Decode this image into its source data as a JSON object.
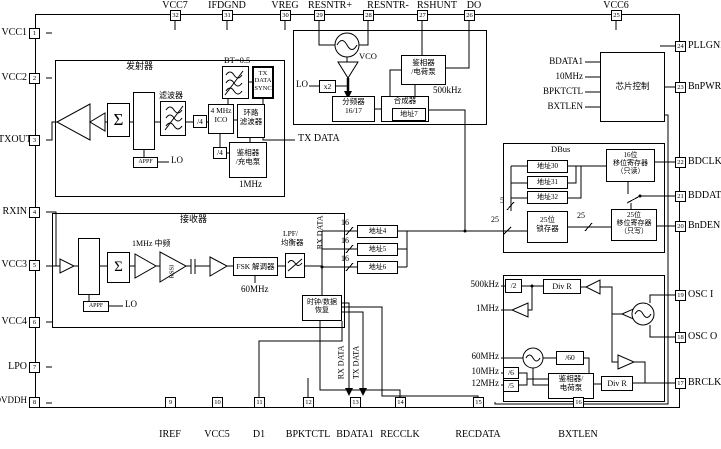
{
  "pins": {
    "top": [
      {
        "n": "32",
        "l": "VCC7"
      },
      {
        "n": "31",
        "l": "IFDGND"
      },
      {
        "n": "30",
        "l": "VREG"
      },
      {
        "n": "29",
        "l": "RESNTR+"
      },
      {
        "n": "28",
        "l": "RESNTR-"
      },
      {
        "n": "27",
        "l": "RSHUNT"
      },
      {
        "n": "26",
        "l": "DO"
      },
      {
        "n": "25",
        "l": "VCC6"
      }
    ],
    "left": [
      {
        "n": "1",
        "l": "VCC1"
      },
      {
        "n": "2",
        "l": "VCC2"
      },
      {
        "n": "3",
        "l": "TXOUT"
      },
      {
        "n": "4",
        "l": "RXIN"
      },
      {
        "n": "5",
        "l": "VCC3"
      },
      {
        "n": "6",
        "l": "VCC4"
      },
      {
        "n": "7",
        "l": "LPO"
      },
      {
        "n": "8",
        "l": "DVDDH"
      }
    ],
    "right": [
      {
        "n": "24",
        "l": "PLLGND"
      },
      {
        "n": "23",
        "l": "BnPWR"
      },
      {
        "n": "22",
        "l": "BDCLK"
      },
      {
        "n": "21",
        "l": "BDDATA"
      },
      {
        "n": "20",
        "l": "BnDEN"
      },
      {
        "n": "19",
        "l": "OSC I"
      },
      {
        "n": "18",
        "l": "OSC O"
      },
      {
        "n": "17",
        "l": "BRCLK"
      }
    ],
    "bottom": [
      {
        "n": "9",
        "l": "IREF"
      },
      {
        "n": "10",
        "l": "VCC5"
      },
      {
        "n": "11",
        "l": "D1"
      },
      {
        "n": "12",
        "l": "BPKTCTL"
      },
      {
        "n": "13",
        "l": "BDATA1"
      },
      {
        "n": "14",
        "l": "RECCLK"
      },
      {
        "n": "15",
        "l": "RECDATA"
      },
      {
        "n": "16",
        "l": "BXTLEN"
      }
    ]
  },
  "tx": {
    "title": "发射器",
    "sigma": "Σ",
    "filter": "滤波器",
    "div4a": "/4",
    "div4b": "/4",
    "ico1": "4 MHz",
    "ico2": "ICO",
    "loop1": "环路",
    "loop2": "滤波器",
    "bt": "BT=0.5",
    "sync1": "TX",
    "sync2": "DATA",
    "sync3": "SYNC",
    "pd1": "鉴相器",
    "pd2": "/充电泵",
    "f1": "1MHz",
    "appf": "APPF",
    "lo": "LO",
    "txdata": "TX DATA"
  },
  "syn": {
    "vco": "VCO",
    "lo": "LO",
    "x2": "x2",
    "dv1": "分频器",
    "dv2": "16/17",
    "mix": "合成器",
    "addr7": "地址7",
    "pd1": "鉴相器",
    "pd2": "/电荷泵",
    "f": "500kHz"
  },
  "cc": {
    "title": "芯片控制",
    "in1": "BDATA1",
    "in2": "10MHz",
    "in3": "BPKTCTL",
    "in4": "BXTLEN"
  },
  "dbus": {
    "title": "DBus",
    "a30": "地址30",
    "a31": "地址31",
    "a32": "地址32",
    "lat1": "25位",
    "lat2": "锁存器",
    "s16a": "16位",
    "s16b": "移位寄存器",
    "s16c": "（只读）",
    "s25a": "25位",
    "s25b": "移位寄存器",
    "s25c": "（只写）",
    "w5": "5",
    "w25": "25"
  },
  "rx": {
    "title": "接收器",
    "sigma": "Σ",
    "iflabel": "1MHz 中频",
    "rssi": "RSSI",
    "fsk": "FSK 解调器",
    "f60": "60MHz",
    "lpf1": "LPF/",
    "lpf2": "均衡器",
    "rxdata": "RX DATA",
    "cdr1": "时钟/数据",
    "cdr2": "恢复",
    "appf": "APPF",
    "lo": "LO"
  },
  "areg": {
    "a4": "地址4",
    "a5": "地址5",
    "a6": "地址6",
    "w16": "16"
  },
  "clk": {
    "f500": "500kHz",
    "div2": "/2",
    "divr": "Div R",
    "f1": "1MHz",
    "f60": "60MHz",
    "f10": "10MHz",
    "f12": "12MHz",
    "d60": "/60",
    "d6": "/6",
    "d5": "/5",
    "pd1": "鉴相器/",
    "pd2": "电荷泵"
  },
  "mid": {
    "rxdata": "RX DATA",
    "txdata": "TX DATA"
  }
}
